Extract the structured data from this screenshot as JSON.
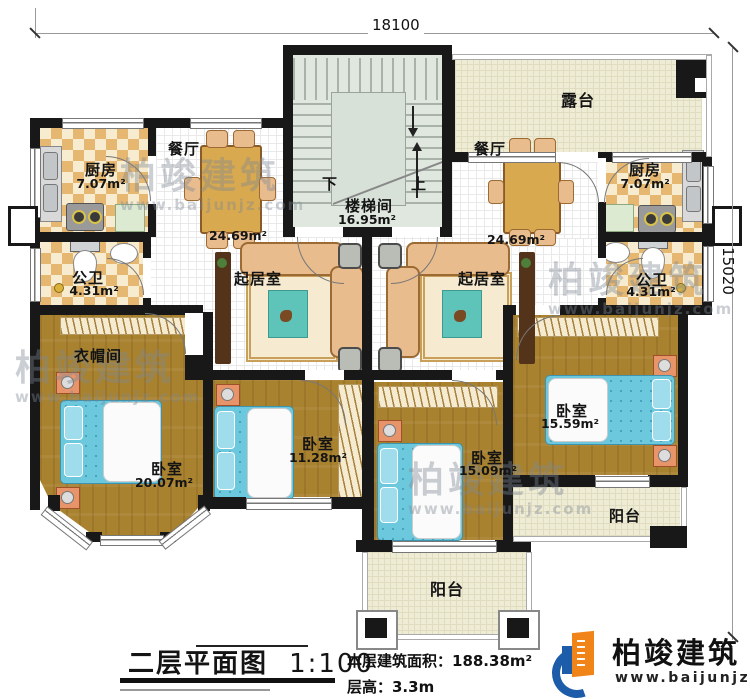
{
  "dimensions": {
    "top": "18100",
    "right": "15020"
  },
  "stairwell": {
    "name": "楼梯间",
    "area": "16.95m²",
    "down": "下",
    "up": "上"
  },
  "rooms": {
    "terrace": {
      "name": "露台"
    },
    "dining_left": {
      "name": "餐厅",
      "area": "24.69m²"
    },
    "dining_right": {
      "name": "餐厅",
      "area": "24.69m²"
    },
    "kitchen_left": {
      "name": "厨房",
      "area": "7.07m²"
    },
    "kitchen_right": {
      "name": "厨房",
      "area": "7.07m²"
    },
    "bath_left": {
      "name": "公卫",
      "area": "4.31m²"
    },
    "bath_right": {
      "name": "公卫",
      "area": "4.31m²"
    },
    "living_left": {
      "name": "起居室"
    },
    "living_right": {
      "name": "起居室"
    },
    "cloakroom": {
      "name": "衣帽间"
    },
    "bedroom_sw": {
      "name": "卧室",
      "area": "20.07m²"
    },
    "bedroom_s1": {
      "name": "卧室",
      "area": "11.28m²"
    },
    "bedroom_s2": {
      "name": "卧室",
      "area": "15.09m²"
    },
    "bedroom_se": {
      "name": "卧室",
      "area": "15.59m²"
    },
    "balcony_right": {
      "name": "阳台"
    },
    "balcony_bottom": {
      "name": "阳台"
    }
  },
  "title_block": {
    "title": "二层平面图",
    "scale": "1:100",
    "area_line": "本层建筑面积：188.38m²",
    "height_line": "层高：3.3m"
  },
  "logo": {
    "name": "柏竣建筑",
    "url": "www.baijunjz.com"
  },
  "watermark": {
    "text": "柏竣建筑",
    "url": "www.baijunjz.com"
  },
  "colors": {
    "wall": "#181818",
    "wood": "#a9822f",
    "checker": "#e5b771",
    "bed": "#6cc8dd",
    "logo_blue": "#1c5ca8",
    "logo_orange": "#f08418"
  }
}
